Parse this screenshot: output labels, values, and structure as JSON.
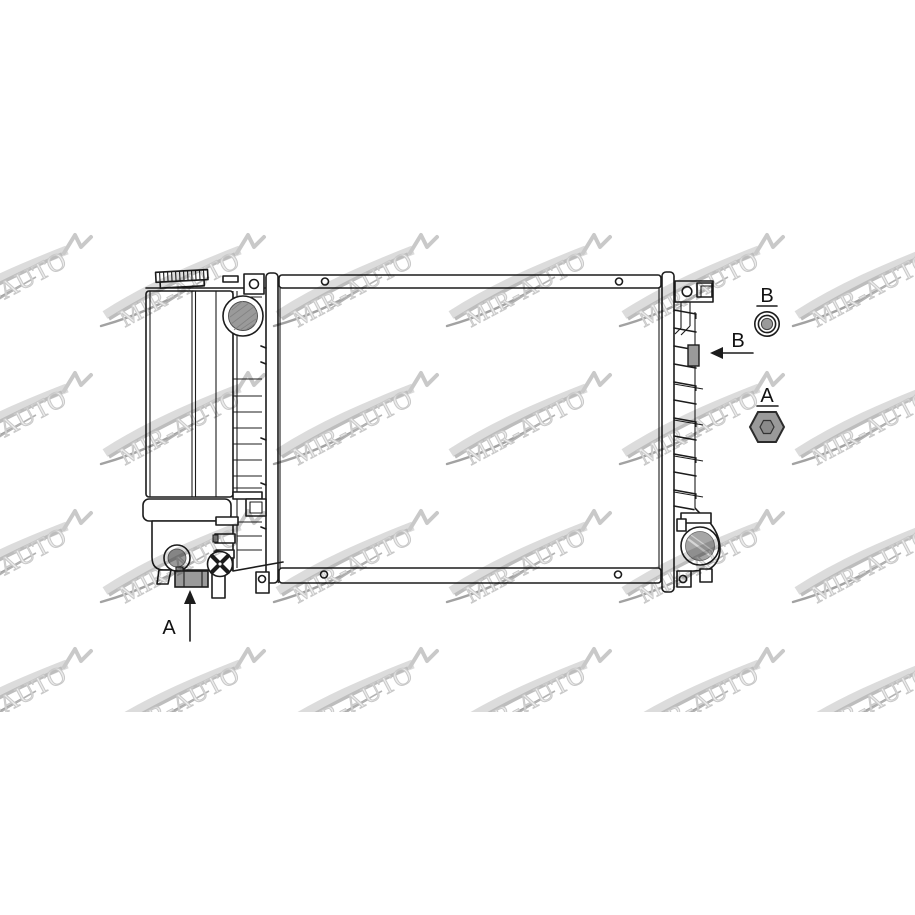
{
  "watermark": {
    "text": "MIR-AUTO"
  },
  "callouts": {
    "pointer_a": "A",
    "pointer_b": "B",
    "detail_a": "A",
    "detail_b": "B"
  },
  "colors": {
    "background": "#ffffff",
    "line": "#1c1c1c",
    "part_gray": "#9a9a9a",
    "part_gray_light": "#a6a6a6",
    "watermark_gray": "#c9c9c9",
    "label_text": "#111111"
  }
}
